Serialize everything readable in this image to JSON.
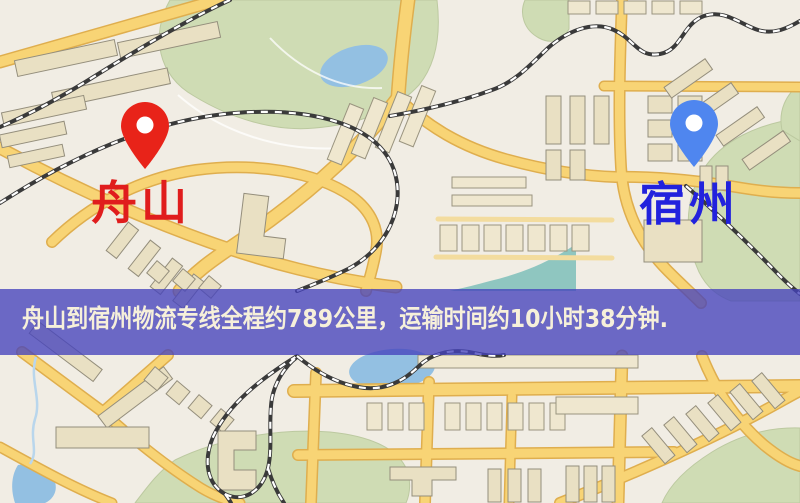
{
  "route_banner": {
    "text": "舟山到宿州物流专线全程约789公里，运输时间约10小时38分钟.",
    "origin": "舟山",
    "destination": "宿州",
    "distance": "789公里",
    "duration": "10小时38分钟",
    "bg_color": "#4543bd",
    "text_color": "#f6f0da"
  },
  "map": {
    "origin_marker": {
      "label": "舟山",
      "pin_color": "#e82319",
      "label_color": "#e01d1d"
    },
    "destination_marker": {
      "label": "宿州",
      "pin_color": "#4f86ef",
      "label_color": "#2222dd"
    },
    "palette": {
      "background": "#f1ede4",
      "road": "#f8d475",
      "road_casing": "#dfae4e",
      "park": "#cfdcb4",
      "water": "#93c0e2",
      "building": "#e9e0c3",
      "railway": "#3a3a3a"
    }
  }
}
